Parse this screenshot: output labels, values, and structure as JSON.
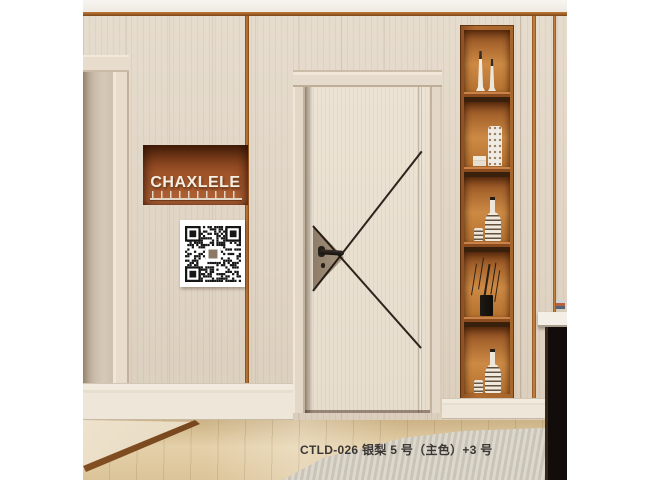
{
  "scene": {
    "brand_sign": {
      "label": "CHAXLELE"
    },
    "qr_plaque": {
      "icon": "qr-code"
    },
    "caption": "CTLD-026 银梨 5 号（主色）+3 号",
    "shelf": {
      "compartments": [
        {
          "items": [
            "candlestick-pair"
          ]
        },
        {
          "items": [
            "book-stack",
            "perforated-vase"
          ]
        },
        {
          "items": [
            "small-cup",
            "striped-bottle"
          ]
        },
        {
          "items": [
            "branch-vase"
          ]
        },
        {
          "items": [
            "small-cup",
            "striped-bottle"
          ]
        }
      ]
    },
    "colors": {
      "wall": "#e2d6c6",
      "door_leaf": "#eae1d2",
      "copper": "#a9672e",
      "niche_back": "#9d5228",
      "floor": "#d8c098",
      "carpet": "#d4cec2",
      "brand_text": "#f6f0e4",
      "caption_text": "#3b3734",
      "table_black": "#120d0a",
      "line": "#1c140d"
    }
  }
}
